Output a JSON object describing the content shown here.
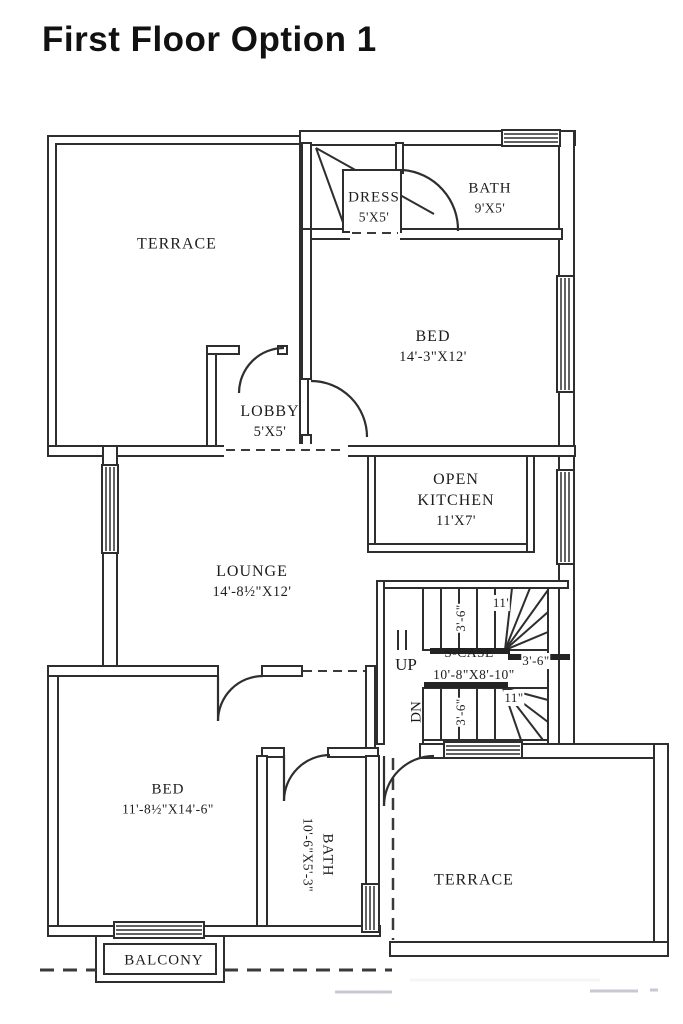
{
  "page": {
    "title": "First Floor Option 1"
  },
  "plan": {
    "labels": {
      "terrace_top": {
        "name": "TERRACE"
      },
      "dress": {
        "name": "DRESS",
        "dims": "5'X5'"
      },
      "bath_top": {
        "name": "BATH",
        "dims": "9'X5'"
      },
      "bed_top": {
        "name": "BED",
        "dims": "14'-3\"X12'"
      },
      "lobby": {
        "name": "LOBBY",
        "dims": "5'X5'"
      },
      "kitchen": {
        "name": "OPEN KITCHEN",
        "dims": "11'X7'"
      },
      "lounge": {
        "name": "LOUNGE",
        "dims": "14'-8½\"X12'"
      },
      "bed_bottom": {
        "name": "BED",
        "dims": "11'-8½\"X14'-6\""
      },
      "bath_bottom": {
        "name": "BATH",
        "dims": "10'-6\"X5'-3\""
      },
      "terrace_bottom": {
        "name": "TERRACE"
      },
      "balcony": {
        "name": "BALCONY"
      }
    },
    "stairs": {
      "name": "S-CASE",
      "dims": "10'-8\"X8'-10\"",
      "up": "UP",
      "down": "DN",
      "dim_top_flight_width": "3'-6\"",
      "dim_top_tread": "11'",
      "dim_landing": "3'-6\"",
      "dim_bottom_flight_width": "3'-6\"",
      "dim_bottom_tread": "11\""
    }
  }
}
